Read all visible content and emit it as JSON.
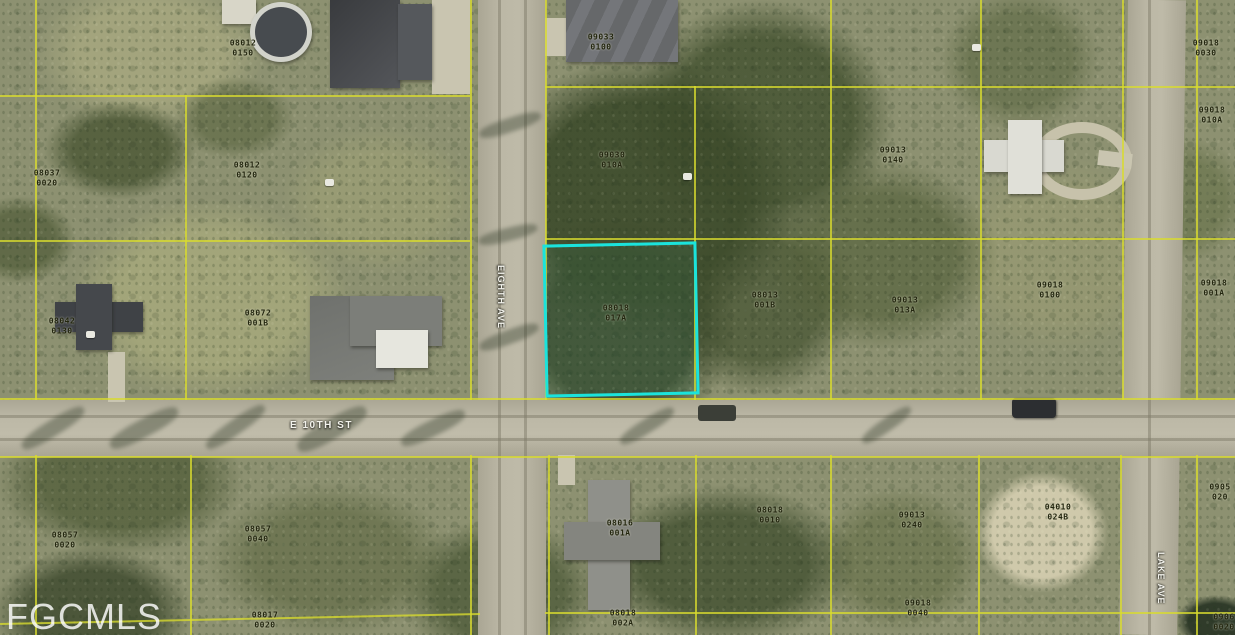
{
  "watermark": "FGCMLS",
  "streets": [
    {
      "name": "E 10TH ST",
      "orientation": "horizontal"
    },
    {
      "name": "EIGHTH AVE",
      "orientation": "vertical"
    },
    {
      "name": "LAKE AVE",
      "orientation": "vertical"
    }
  ],
  "highlighted_parcel": {
    "line1": "08018",
    "line2": "017A",
    "outline_color": "#1BE3DC"
  },
  "parcel_labels": [
    {
      "line1": "08012",
      "line2": "0150",
      "x": 243,
      "y": 48
    },
    {
      "line1": "09033",
      "line2": "0100",
      "x": 601,
      "y": 42
    },
    {
      "line1": "09018",
      "line2": "0030",
      "x": 1206,
      "y": 48
    },
    {
      "line1": "08037",
      "line2": "0020",
      "x": 47,
      "y": 178
    },
    {
      "line1": "08012",
      "line2": "0120",
      "x": 247,
      "y": 170
    },
    {
      "line1": "09030",
      "line2": "010A",
      "x": 612,
      "y": 160
    },
    {
      "line1": "09013",
      "line2": "0140",
      "x": 893,
      "y": 155
    },
    {
      "line1": "09018",
      "line2": "010A",
      "x": 1212,
      "y": 115
    },
    {
      "line1": "08042",
      "line2": "0130",
      "x": 62,
      "y": 326
    },
    {
      "line1": "08072",
      "line2": "001B",
      "x": 258,
      "y": 318
    },
    {
      "line1": "08013",
      "line2": "001B",
      "x": 765,
      "y": 300
    },
    {
      "line1": "09013",
      "line2": "013A",
      "x": 905,
      "y": 305
    },
    {
      "line1": "09018",
      "line2": "0100",
      "x": 1050,
      "y": 290
    },
    {
      "line1": "09018",
      "line2": "001A",
      "x": 1214,
      "y": 288
    },
    {
      "line1": "08057",
      "line2": "0020",
      "x": 65,
      "y": 540
    },
    {
      "line1": "08057",
      "line2": "0040",
      "x": 258,
      "y": 534
    },
    {
      "line1": "08016",
      "line2": "001A",
      "x": 620,
      "y": 528
    },
    {
      "line1": "08018",
      "line2": "0010",
      "x": 770,
      "y": 515
    },
    {
      "line1": "09013",
      "line2": "0240",
      "x": 912,
      "y": 520
    },
    {
      "line1": "04010",
      "line2": "024B",
      "x": 1058,
      "y": 512
    },
    {
      "line1": "0905",
      "line2": "020",
      "x": 1220,
      "y": 492
    },
    {
      "line1": "08017",
      "line2": "0020",
      "x": 265,
      "y": 620
    },
    {
      "line1": "08018",
      "line2": "002A",
      "x": 623,
      "y": 618
    },
    {
      "line1": "09018",
      "line2": "0040",
      "x": 918,
      "y": 608
    },
    {
      "line1": "0906",
      "line2": "0020",
      "x": 1224,
      "y": 622
    }
  ],
  "ground_markers": [
    {
      "x": 972,
      "y": 44
    },
    {
      "x": 325,
      "y": 179
    },
    {
      "x": 86,
      "y": 331
    },
    {
      "x": 683,
      "y": 173
    }
  ],
  "colors": {
    "parcel_line": "#d8db2e",
    "highlight_outline": "#1BE3DC",
    "road": "#b9b5a3",
    "watermark": "rgba(255,255,255,0.82)"
  }
}
